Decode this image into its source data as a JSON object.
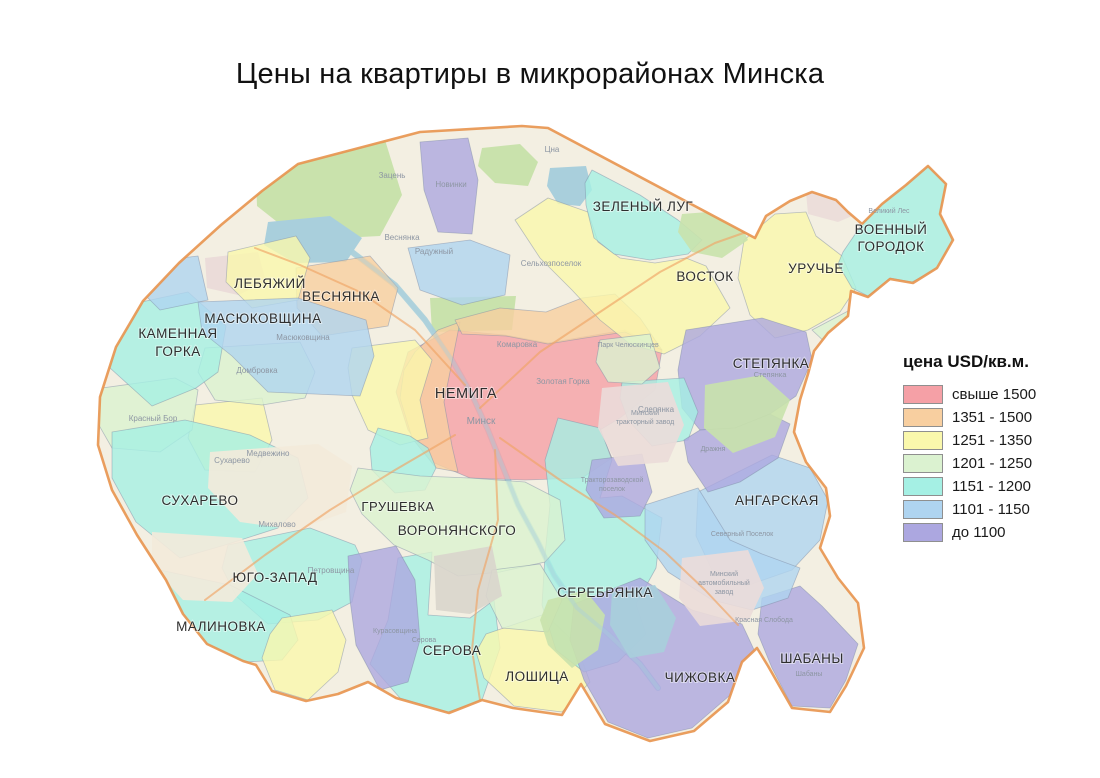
{
  "title": "Цены на квартиры в микрорайонах Минска",
  "legend": {
    "title": "цена USD/кв.м.",
    "items": [
      {
        "key": "c1",
        "label": "свыше 1500",
        "color": "#F5A0A6"
      },
      {
        "key": "c2",
        "label": "1351 - 1500",
        "color": "#F8CFA0"
      },
      {
        "key": "c3",
        "label": "1251 - 1350",
        "color": "#FAF8AC"
      },
      {
        "key": "c4",
        "label": "1201 - 1250",
        "color": "#DBF2D0"
      },
      {
        "key": "c5",
        "label": "1151 - 1200",
        "color": "#A5F0E4"
      },
      {
        "key": "c6",
        "label": "1101 - 1150",
        "color": "#AFD4F0"
      },
      {
        "key": "c7",
        "label": "до 1100",
        "color": "#ACA7E0"
      }
    ]
  },
  "map": {
    "palette": {
      "base": "#F3EFE2",
      "forest": "#C9E2AC",
      "water": "#A9CFDC",
      "industrial": "#EBDCD9",
      "sand": "#F3EADA",
      "runway": "#D9D5CC",
      "road": "#F0A466",
      "mkad": "#E8934E",
      "border": "#7D8CA6",
      "label": "#2E2E2E",
      "place_label": "#8D96A3"
    },
    "outline": "298,164 420,132 522,126 548,128 755,238 766,216 790,201 812,192 836,200 848,212 862,224 882,204 906,185 928,166 946,184 940,214 953,240 937,268 913,283 890,279 868,297 851,291 848,316 828,333 814,351 808,374 800,400 794,432 806,462 826,488 830,516 820,548 838,578 858,603 864,648 846,686 830,712 792,708 768,666 757,648 742,662 728,702 694,731 650,741 605,724 581,684 562,715 513,708 482,700 449,713 396,698 368,682 338,694 306,701 272,691 256,665 243,661 207,644 183,614 166,580 137,535 112,490 98,445 100,397 116,347 143,301 179,263 221,225 262,191",
    "base_patches": [
      {
        "kind": "forest",
        "over": false,
        "pts": "255,150 385,140 402,195 380,236 300,240 257,206"
      },
      {
        "kind": "forest",
        "over": false,
        "pts": "430,298 516,296 512,330 432,332"
      },
      {
        "kind": "forest",
        "over": false,
        "pts": "482,148 520,144 538,162 528,186 495,183 478,166"
      },
      {
        "kind": "industrial",
        "over": false,
        "pts": "205,258 258,252 266,282 238,295 207,288"
      },
      {
        "kind": "water",
        "over": false,
        "pts": "268,222 330,216 362,238 346,262 295,263 264,245"
      },
      {
        "kind": "water",
        "over": false,
        "pts": "550,168 586,166 592,190 580,206 558,204 547,186"
      },
      {
        "kind": "sand",
        "over": true,
        "pts": "210,452 318,444 352,466 346,512 296,530 240,522 208,488"
      },
      {
        "kind": "sand",
        "over": true,
        "pts": "152,532 242,538 258,574 232,602 183,600 152,566"
      },
      {
        "kind": "industrial",
        "over": true,
        "pts": "602,388 668,382 684,425 668,462 618,466 598,428"
      },
      {
        "kind": "industrial",
        "over": true,
        "pts": "682,558 748,550 764,588 749,620 700,626 679,598"
      },
      {
        "kind": "industrial",
        "over": true,
        "pts": "806,192 858,188 866,210 838,222 808,214"
      },
      {
        "kind": "runway",
        "over": true,
        "pts": "434,556 492,546 502,596 470,614 436,610"
      },
      {
        "kind": "forest",
        "over": true,
        "pts": "705,385 762,375 790,400 775,437 733,453 704,428"
      },
      {
        "kind": "forest",
        "over": true,
        "pts": "548,600 585,590 605,615 598,650 572,668 548,645 540,620"
      },
      {
        "kind": "forest",
        "over": true,
        "pts": "682,214 734,210 748,240 722,258 692,252 678,232"
      },
      {
        "kind": "water",
        "over": true,
        "pts": "612,592 655,585 676,618 664,652 630,658 610,625"
      }
    ],
    "river": "352,252 395,285 425,320 452,360 472,395 488,430 502,465 518,505 538,542 554,575 577,608 608,634 640,664 658,688",
    "roads": [
      "480,408 540,352 600,312 660,272 715,243 752,230",
      "500,438 560,480 615,515 665,552 705,590 738,625",
      "455,435 395,470 330,510 265,555 205,600",
      "465,385 415,330 360,292 300,265 255,248",
      "495,450 498,520 478,590 472,650 480,700"
    ],
    "regions": [
      {
        "name": "nemiga",
        "cat": "c1",
        "pts": "408,352 450,330 505,335 548,343 583,337 625,330 662,350 655,390 620,418 600,430 612,458 582,478 525,480 470,478 432,462 408,430 396,392"
      },
      {
        "name": "vesnyanka",
        "cat": "c2",
        "pts": "296,268 370,256 398,288 388,326 322,336 297,308"
      },
      {
        "name": "center-west-ring",
        "cat": "c2",
        "pts": "415,352 438,330 460,322 452,362 444,402 452,446 458,472 436,468 412,438 400,398 404,370"
      },
      {
        "name": "komarovka-ring",
        "cat": "c2",
        "pts": "455,320 500,308 546,312 582,298 615,294 640,318 662,350 625,332 585,338 548,344 506,336 462,334"
      },
      {
        "name": "zapad-north",
        "cat": "c3",
        "pts": "352,348 415,340 432,360 420,400 428,438 400,445 368,430 352,395 348,368"
      },
      {
        "name": "zapad-south",
        "cat": "c3",
        "pts": "195,405 262,398 272,440 255,472 205,470 188,438"
      },
      {
        "name": "rozy-luxemburg",
        "cat": "c5",
        "pts": "378,428 410,436 428,448 436,468 425,490 395,493 372,470 370,448"
      },
      {
        "name": "kuntsevshina",
        "cat": "c4",
        "pts": "205,348 300,342 315,372 305,398 262,405 215,400 198,372"
      },
      {
        "name": "krasny-bor",
        "cat": "c4",
        "pts": "102,388 175,378 198,390 192,430 160,452 112,448 96,420"
      },
      {
        "name": "kamennaya-gorka",
        "cat": "c5",
        "pts": "104,310 188,292 226,326 218,372 196,388 152,406 110,368 98,340"
      },
      {
        "name": "suharevo",
        "cat": "c5",
        "pts": "112,432 185,420 250,435 298,458 308,498 278,528 225,545 180,558 136,522 112,478"
      },
      {
        "name": "yugo-zapad",
        "cat": "c5",
        "pts": "228,545 310,528 355,545 362,560 352,602 318,620 268,624 236,596 222,568"
      },
      {
        "name": "malinovka",
        "cat": "c5",
        "pts": "160,570 230,585 290,615 298,640 282,660 245,662 205,643 178,615 156,590"
      },
      {
        "name": "serova",
        "cat": "c5",
        "pts": "398,558 432,552 428,615 470,618 494,600 500,648 482,700 448,712 400,698 370,664 388,620"
      },
      {
        "name": "loshitsa",
        "cat": "c3",
        "pts": "486,634 545,614 576,644 590,682 562,712 514,706 484,678 476,652"
      },
      {
        "name": "serebryanka",
        "cat": "c5",
        "pts": "558,418 600,428 612,460 600,498 622,496 662,518 656,568 636,604 646,634 618,662 584,672 556,650 542,605 545,555 550,505 545,460"
      },
      {
        "name": "chizhovka",
        "cat": "c7",
        "pts": "574,604 640,578 692,610 742,624 756,654 736,690 692,728 648,738 608,722 584,680 570,640"
      },
      {
        "name": "shabany",
        "cat": "c7",
        "pts": "762,598 800,586 822,606 858,644 846,680 830,708 792,706 772,668 758,634"
      },
      {
        "name": "angarskaya",
        "cat": "c6",
        "pts": "698,492 772,455 810,468 828,500 820,540 792,570 746,586 712,570 696,536"
      },
      {
        "name": "maz-north",
        "cat": "c6",
        "pts": "645,505 698,488 730,540 762,554 800,568 788,598 752,610 712,600 668,572 645,540"
      },
      {
        "name": "kurasovshina",
        "cat": "c7",
        "pts": "348,556 396,546 415,580 420,640 408,682 380,690 356,645 350,600"
      },
      {
        "name": "grushevka-voronyanskogo",
        "cat": "c4",
        "pts": "358,468 420,476 470,478 525,482 560,500 565,540 545,562 500,572 458,576 428,560 394,545 362,514 350,490"
      },
      {
        "name": "loshitsa-park-east",
        "cat": "c4",
        "pts": "492,570 540,564 562,600 548,632 502,628 486,596"
      },
      {
        "name": "vostok",
        "cat": "c3",
        "pts": "515,220 548,198 588,212 598,242 620,258 655,263 686,258 706,266 730,308 700,336 664,354 630,344 600,320 572,290 540,258"
      },
      {
        "name": "uruchye",
        "cat": "c3",
        "pts": "744,240 775,214 806,212 816,236 842,256 856,288 840,312 808,330 775,338 750,315 738,278"
      },
      {
        "name": "voenny-gorodok",
        "cat": "c5",
        "pts": "843,252 862,224 882,204 906,184 928,166 946,184 940,214 952,240 938,268 912,282 890,278 868,296 852,288 838,264"
      },
      {
        "name": "zeleny-lug",
        "cat": "c5",
        "pts": "592,170 640,195 678,220 702,240 688,254 650,260 614,254 594,238 586,205 585,183"
      },
      {
        "name": "novinki",
        "cat": "c7",
        "pts": "420,142 468,138 478,180 472,234 438,232 424,190"
      },
      {
        "name": "north-blue",
        "cat": "c6",
        "pts": "408,248 470,240 510,255 505,295 462,305 420,290"
      },
      {
        "name": "stepyanka",
        "cat": "c7",
        "pts": "686,330 762,318 806,332 812,360 796,396 770,414 735,428 700,430 682,408 678,370 682,348"
      },
      {
        "name": "slepyanka",
        "cat": "c5",
        "pts": "622,382 684,378 698,412 688,440 652,446 628,420 620,398"
      },
      {
        "name": "drazhnya",
        "cat": "c7",
        "pts": "700,430 735,428 770,414 790,424 778,458 740,482 708,492 688,462 684,440"
      },
      {
        "name": "traktorozavodskoy",
        "cat": "c7",
        "pts": "592,460 642,454 652,492 640,516 604,518 586,490"
      },
      {
        "name": "lebyazhy",
        "cat": "c3",
        "pts": "228,252 296,236 310,258 298,300 252,308 226,282"
      },
      {
        "name": "masyukovshina",
        "cat": "c6",
        "pts": "198,302 298,298 366,320 374,356 360,396 268,392 232,356 202,332"
      },
      {
        "name": "masyukovshina-west",
        "cat": "c6",
        "pts": "148,262 198,256 208,300 160,310 138,288"
      },
      {
        "name": "brilevichi",
        "cat": "c3",
        "pts": "282,618 332,610 346,640 338,672 308,700 275,690 262,658 270,634"
      },
      {
        "name": "veliky-les-green",
        "cat": "c4",
        "pts": "812,330 850,310 868,296 890,280 902,296 888,322 858,340 828,345"
      },
      {
        "name": "botsad-green",
        "cat": "c4",
        "pts": "600,340 650,334 660,368 642,384 608,382 596,362"
      }
    ],
    "districts": [
      {
        "name": "zeleny-lug",
        "lines": [
          "ЗЕЛЕНЫЙ ЛУГ"
        ],
        "x": 643,
        "y": 211
      },
      {
        "name": "voenny-gorodok",
        "lines": [
          "ВОЕННЫЙ",
          "ГОРОДОК"
        ],
        "x": 891,
        "y": 234,
        "lh": 17
      },
      {
        "name": "vostok",
        "lines": [
          "ВОСТОК"
        ],
        "x": 705,
        "y": 281
      },
      {
        "name": "uruchye",
        "lines": [
          "УРУЧЬЕ"
        ],
        "x": 816,
        "y": 273
      },
      {
        "name": "lebyazhy",
        "lines": [
          "ЛЕБЯЖИЙ"
        ],
        "x": 270,
        "y": 288
      },
      {
        "name": "vesnyanka",
        "lines": [
          "ВЕСНЯНКА"
        ],
        "x": 341,
        "y": 301
      },
      {
        "name": "masyukovshina",
        "lines": [
          "МАСЮКОВЩИНА"
        ],
        "x": 263,
        "y": 323
      },
      {
        "name": "kamennaya-gorka",
        "lines": [
          "КАМЕННАЯ",
          "ГОРКА"
        ],
        "x": 178,
        "y": 338,
        "lh": 18
      },
      {
        "name": "stepyanka",
        "lines": [
          "СТЕПЯНКА"
        ],
        "x": 771,
        "y": 368
      },
      {
        "name": "nemiga",
        "lines": [
          "НЕМИГА"
        ],
        "x": 466,
        "y": 398,
        "fs": 14.5
      },
      {
        "name": "suharevo",
        "lines": [
          "СУХАРЕВО"
        ],
        "x": 200,
        "y": 505
      },
      {
        "name": "grushevka",
        "lines": [
          "ГРУШЕВКА"
        ],
        "x": 398,
        "y": 511,
        "fs": 13
      },
      {
        "name": "voronyanskogo",
        "lines": [
          "ВОРОНЯНСКОГО"
        ],
        "x": 457,
        "y": 535
      },
      {
        "name": "angarskaya",
        "lines": [
          "АНГАРСКАЯ"
        ],
        "x": 777,
        "y": 505
      },
      {
        "name": "yugo-zapad",
        "lines": [
          "ЮГО-ЗАПАД"
        ],
        "x": 275,
        "y": 582
      },
      {
        "name": "serebryanka",
        "lines": [
          "СЕРЕБРЯНКА"
        ],
        "x": 605,
        "y": 597
      },
      {
        "name": "malinovka",
        "lines": [
          "МАЛИНОВКА"
        ],
        "x": 221,
        "y": 631
      },
      {
        "name": "serova",
        "lines": [
          "СЕРОВА"
        ],
        "x": 452,
        "y": 655
      },
      {
        "name": "loshitsa",
        "lines": [
          "ЛОШИЦА"
        ],
        "x": 537,
        "y": 681
      },
      {
        "name": "chizhovka",
        "lines": [
          "ЧИЖОВКА"
        ],
        "x": 700,
        "y": 682
      },
      {
        "name": "shabany",
        "lines": [
          "ШАБАНЫ"
        ],
        "x": 812,
        "y": 663
      }
    ],
    "places": [
      {
        "t": "Зацень",
        "x": 392,
        "y": 178
      },
      {
        "t": "Цна",
        "x": 552,
        "y": 152
      },
      {
        "t": "Новинки",
        "x": 451,
        "y": 187
      },
      {
        "t": "Веснянка",
        "x": 402,
        "y": 240
      },
      {
        "t": "Радужный",
        "x": 434,
        "y": 254
      },
      {
        "t": "Масюковщина",
        "x": 303,
        "y": 340
      },
      {
        "t": "Домбровка",
        "x": 257,
        "y": 373
      },
      {
        "t": "Красный Бор",
        "x": 153,
        "y": 421
      },
      {
        "t": "Сухарево",
        "x": 232,
        "y": 463
      },
      {
        "t": "Медвежино",
        "x": 268,
        "y": 456
      },
      {
        "t": "Михалово",
        "x": 277,
        "y": 527
      },
      {
        "t": "Петровщина",
        "x": 331,
        "y": 573
      },
      {
        "t": "Курасовщина",
        "x": 395,
        "y": 633,
        "fs": 7
      },
      {
        "t": "Серова",
        "x": 424,
        "y": 642,
        "fs": 7
      },
      {
        "t": "Комаровка",
        "x": 517,
        "y": 347
      },
      {
        "t": "Золотая Горка",
        "x": 563,
        "y": 384
      },
      {
        "t": "Минск",
        "x": 481,
        "y": 424,
        "fs": 10
      },
      {
        "t": "Слепянка",
        "x": 656,
        "y": 412
      },
      {
        "t": "Дражня",
        "x": 713,
        "y": 451,
        "fs": 7
      },
      {
        "t": "Великий Лес",
        "x": 889,
        "y": 213,
        "fs": 7
      },
      {
        "t": "Северный Поселок",
        "x": 742,
        "y": 536,
        "fs": 7
      },
      {
        "t": "Красная Слобода",
        "x": 764,
        "y": 622,
        "fs": 7
      },
      {
        "t": "Сельхозпоселок",
        "x": 551,
        "y": 266
      },
      {
        "t": "Шабаны",
        "x": 809,
        "y": 676,
        "fs": 7
      },
      {
        "t": "Парк Челюскинцев",
        "x": 628,
        "y": 347,
        "fs": 7
      },
      {
        "t": "Степянка",
        "x": 770,
        "y": 377,
        "fs": 7.5
      },
      {
        "t": "Минский",
        "x": 645,
        "y": 415,
        "fs": 7
      },
      {
        "t": "тракторный завод",
        "x": 645,
        "y": 424,
        "fs": 7
      },
      {
        "t": "Минский",
        "x": 724,
        "y": 576,
        "fs": 7
      },
      {
        "t": "автомобильный",
        "x": 724,
        "y": 585,
        "fs": 7
      },
      {
        "t": "завод",
        "x": 724,
        "y": 594,
        "fs": 7
      },
      {
        "t": "Тракторозаводской",
        "x": 612,
        "y": 482,
        "fs": 7
      },
      {
        "t": "поселок",
        "x": 612,
        "y": 491,
        "fs": 7
      }
    ]
  }
}
